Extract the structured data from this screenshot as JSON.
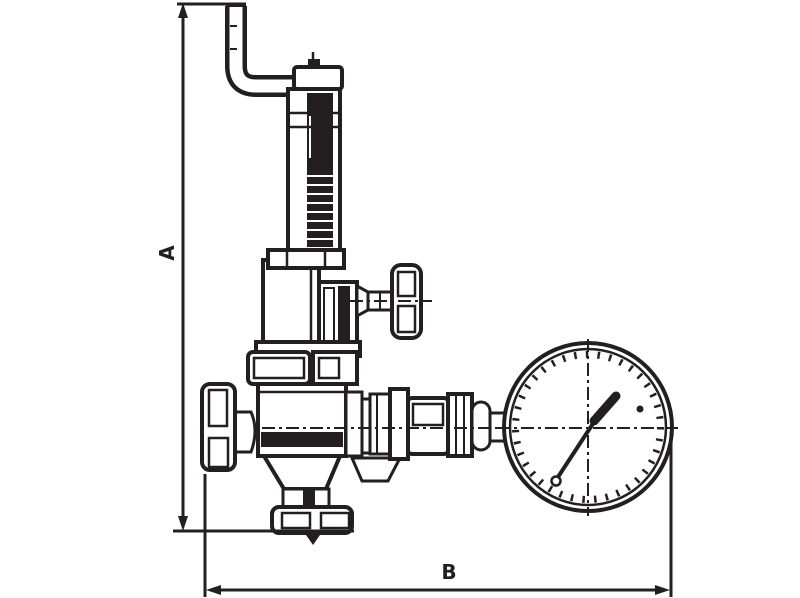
{
  "diagram": {
    "labels": {
      "dimension_vertical": "A",
      "dimension_horizontal": "B"
    },
    "colors": {
      "ink": "#231f20",
      "background": "#ffffff"
    }
  }
}
